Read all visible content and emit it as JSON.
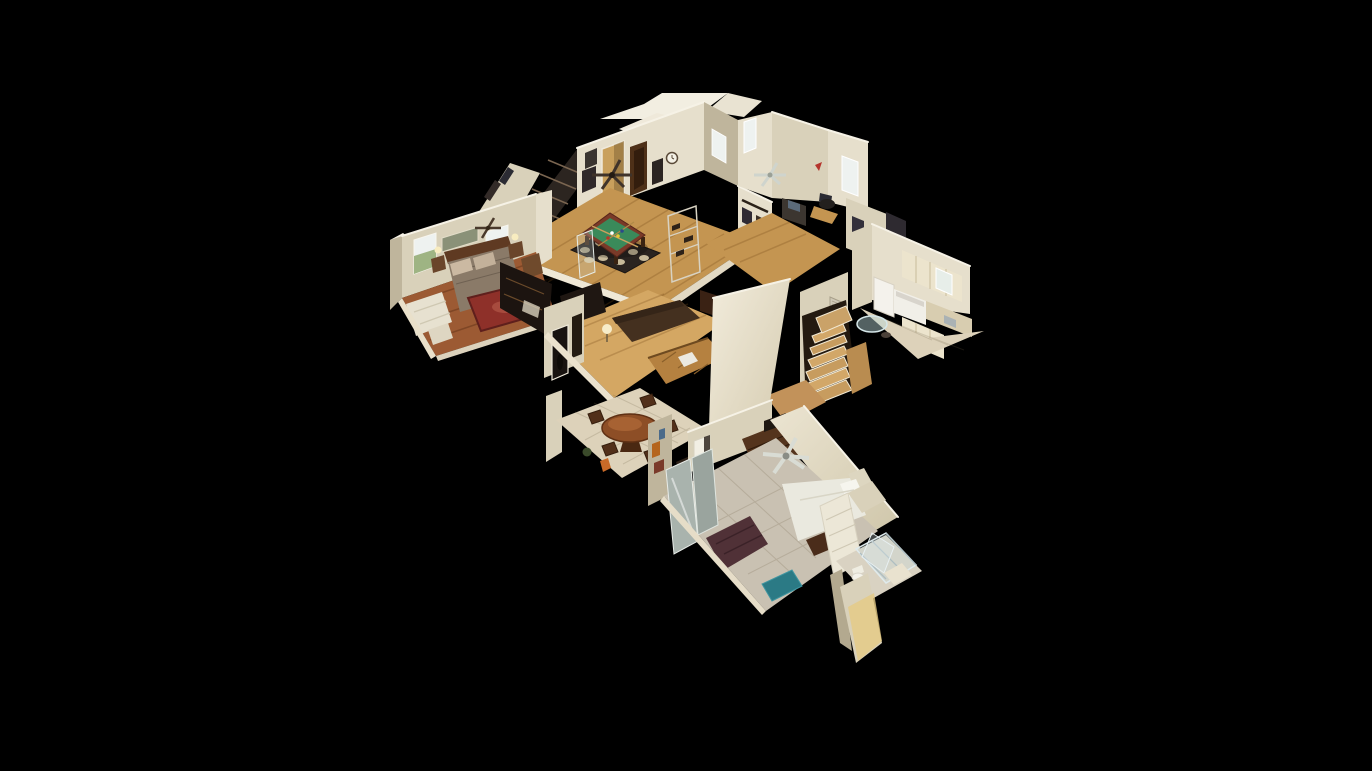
{
  "viewer": {
    "background": "#000000",
    "view": "dollhouse"
  },
  "scene": {
    "description": "3D dollhouse cutaway view of a two-story house floating on a black background",
    "palette": {
      "background": "#000000",
      "ceiling": "#f2eee1",
      "wall_light": "#e6dfcc",
      "wall_cream": "#d9d1ba",
      "wall_shadow": "#bfb59c",
      "wall_bright": "#f6f2e6",
      "floor_oak": "#c49551",
      "floor_oak_light": "#d4a763",
      "floor_pine": "#9c5a33",
      "tile": "#ddd2ba",
      "carpet": "#c9c1b2",
      "cabinet_cream": "#ece4cd",
      "felt_green": "#3a8a5a",
      "table_rail": "#7a3a28",
      "rug_red": "#8e3029",
      "rug_dark": "#2b2420",
      "rug_medallion": "#d9cba8",
      "dresser": "#54341d",
      "stair_wood": "#c79c5f",
      "teal": "#2b7a85",
      "sofa_plum": "#503137",
      "sofa_dark": "#44301f",
      "oak_cabinet": "#b58140",
      "glow": "#e5ca85",
      "window_bright": "#eef2f0",
      "window_green": "#8aa468"
    },
    "rooms": [
      {
        "id": "master-bedroom",
        "label": "Bedroom with wood sleigh bed and red oriental rug"
      },
      {
        "id": "game-room",
        "label": "Game room with green pool table, circle-pattern rug and dark bookshelves"
      },
      {
        "id": "upstairs-hallway",
        "label": "Upstairs hallway with framed pictures on the wall"
      },
      {
        "id": "office",
        "label": "Office with bright window, desk chair and poster wall"
      },
      {
        "id": "kitchen",
        "label": "Kitchen with cream cabinets, white range and round glass table"
      },
      {
        "id": "staircase",
        "label": "Winding oak staircase behind tall angled wall"
      },
      {
        "id": "living-room",
        "label": "Living room with dark sofa, lamp and oak cabinets"
      },
      {
        "id": "dining-room",
        "label": "Dining room with round copper-top table and wood chairs"
      },
      {
        "id": "bedroom-2",
        "label": "Bedroom with white bed, dark dresser, silver ceiling fan and teal bench"
      },
      {
        "id": "bathroom",
        "label": "Bathroom with glass shower, linen closet and warm-lit walls"
      }
    ]
  }
}
